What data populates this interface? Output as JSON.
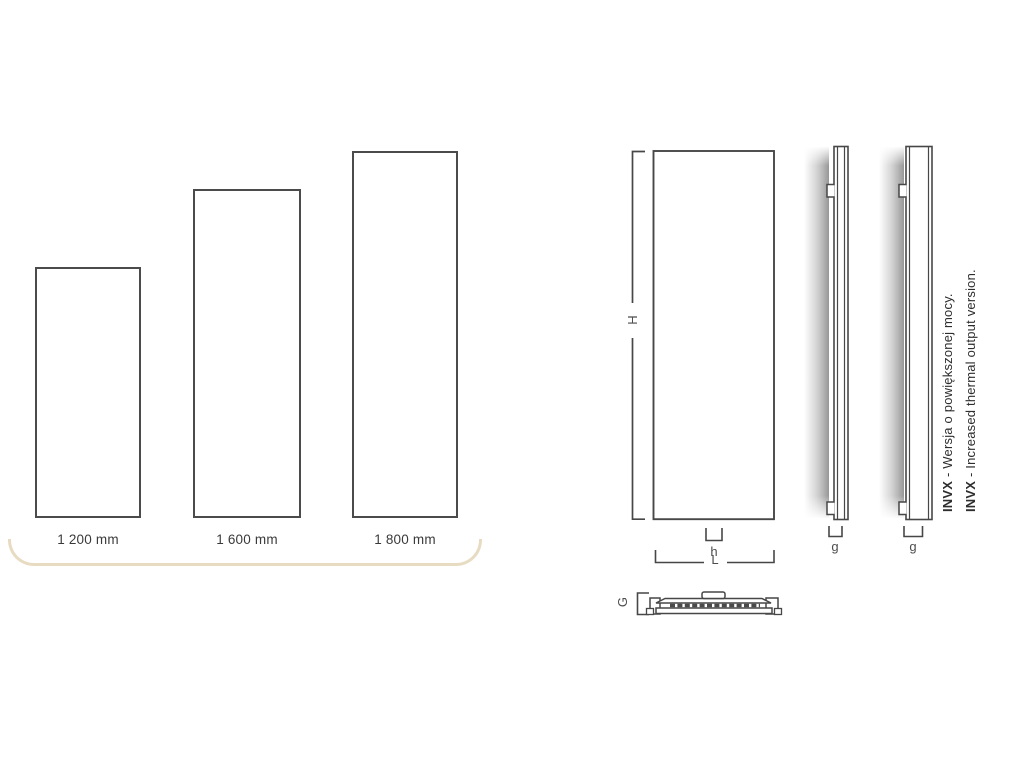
{
  "canvas": {
    "width": 1024,
    "height": 768,
    "background": "#ffffff"
  },
  "palette": {
    "line_color": "#474747",
    "panel_border_color": "#4b4b4b",
    "text_color": "#3a3a3a",
    "accent_underline_color": "#e7dcc2",
    "wall_shade_color": "#8f8f8f"
  },
  "size_comparison": {
    "panels": [
      {
        "label": "1 200 mm"
      },
      {
        "label": "1 600 mm"
      },
      {
        "label": "1 800 mm"
      }
    ]
  },
  "dimensions": {
    "front_height": "H",
    "connection_width": "h",
    "panel_length": "L",
    "side_depth_standard": "g",
    "side_depth_invx": "g",
    "top_depth": "G"
  },
  "notes": [
    {
      "prefix": "INVX",
      "rest": " - Wersja o powiększonej mocy."
    },
    {
      "prefix": "INVX",
      "rest": " - Increased thermal output version."
    }
  ]
}
